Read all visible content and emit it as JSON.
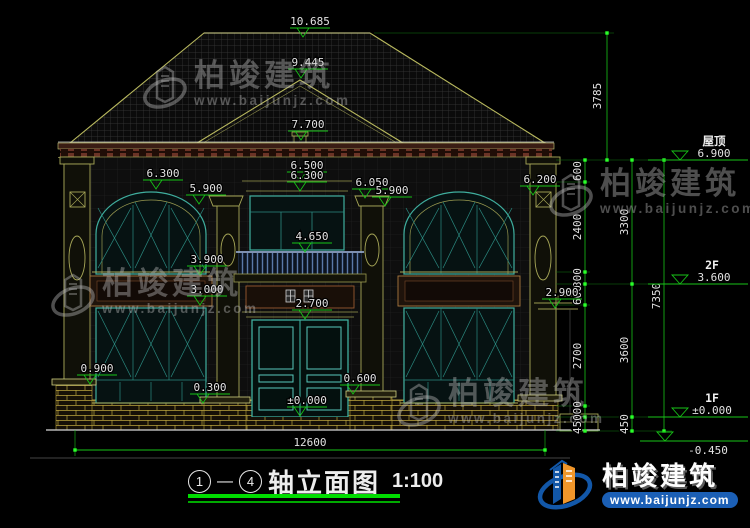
{
  "watermark": {
    "brand": "柏竣建筑",
    "url": "www.baijunjz.com"
  },
  "brand_logo": {
    "name": "柏竣建筑",
    "url": "www.baijunjz.com"
  },
  "title": {
    "axis_from": "1",
    "axis_sep": "—",
    "axis_to": "4",
    "name": "轴立面图",
    "scale": "1:100"
  },
  "markers": [
    "10.685",
    "9.445",
    "7.700",
    "6.500",
    "6.300",
    "6.300",
    "5.900",
    "6.050",
    "5.900",
    "6.200",
    "4.650",
    "3.900",
    "3.000",
    "2.900",
    "2.700",
    "0.900",
    "0.600",
    "0.300",
    "±0.000"
  ],
  "levels": [
    {
      "label": "屋顶",
      "value": "6.900"
    },
    {
      "label": "2F",
      "value": "3.600"
    },
    {
      "label": "1F",
      "value": "±0.000"
    },
    {
      "label": "",
      "value": "-0.450"
    }
  ],
  "chains": {
    "roof": "3785",
    "inner": [
      "600",
      "2400",
      "300",
      "600",
      "2700",
      "300",
      "450"
    ],
    "mid": [
      "3300",
      "3600",
      "450"
    ],
    "total": "7350",
    "bottom": "12600"
  },
  "colors": {
    "dim_green": "#17c417",
    "grip_green": "#2aff2a",
    "dim_text": "#e2e2e2",
    "window_teal": "#3fae9e",
    "trim_olive": "#a8a858",
    "roof_edge": "#b9b95e",
    "brand_blue": "#1257a8",
    "brand_orange": "#f0962a",
    "title_underline": "#00dd00"
  }
}
